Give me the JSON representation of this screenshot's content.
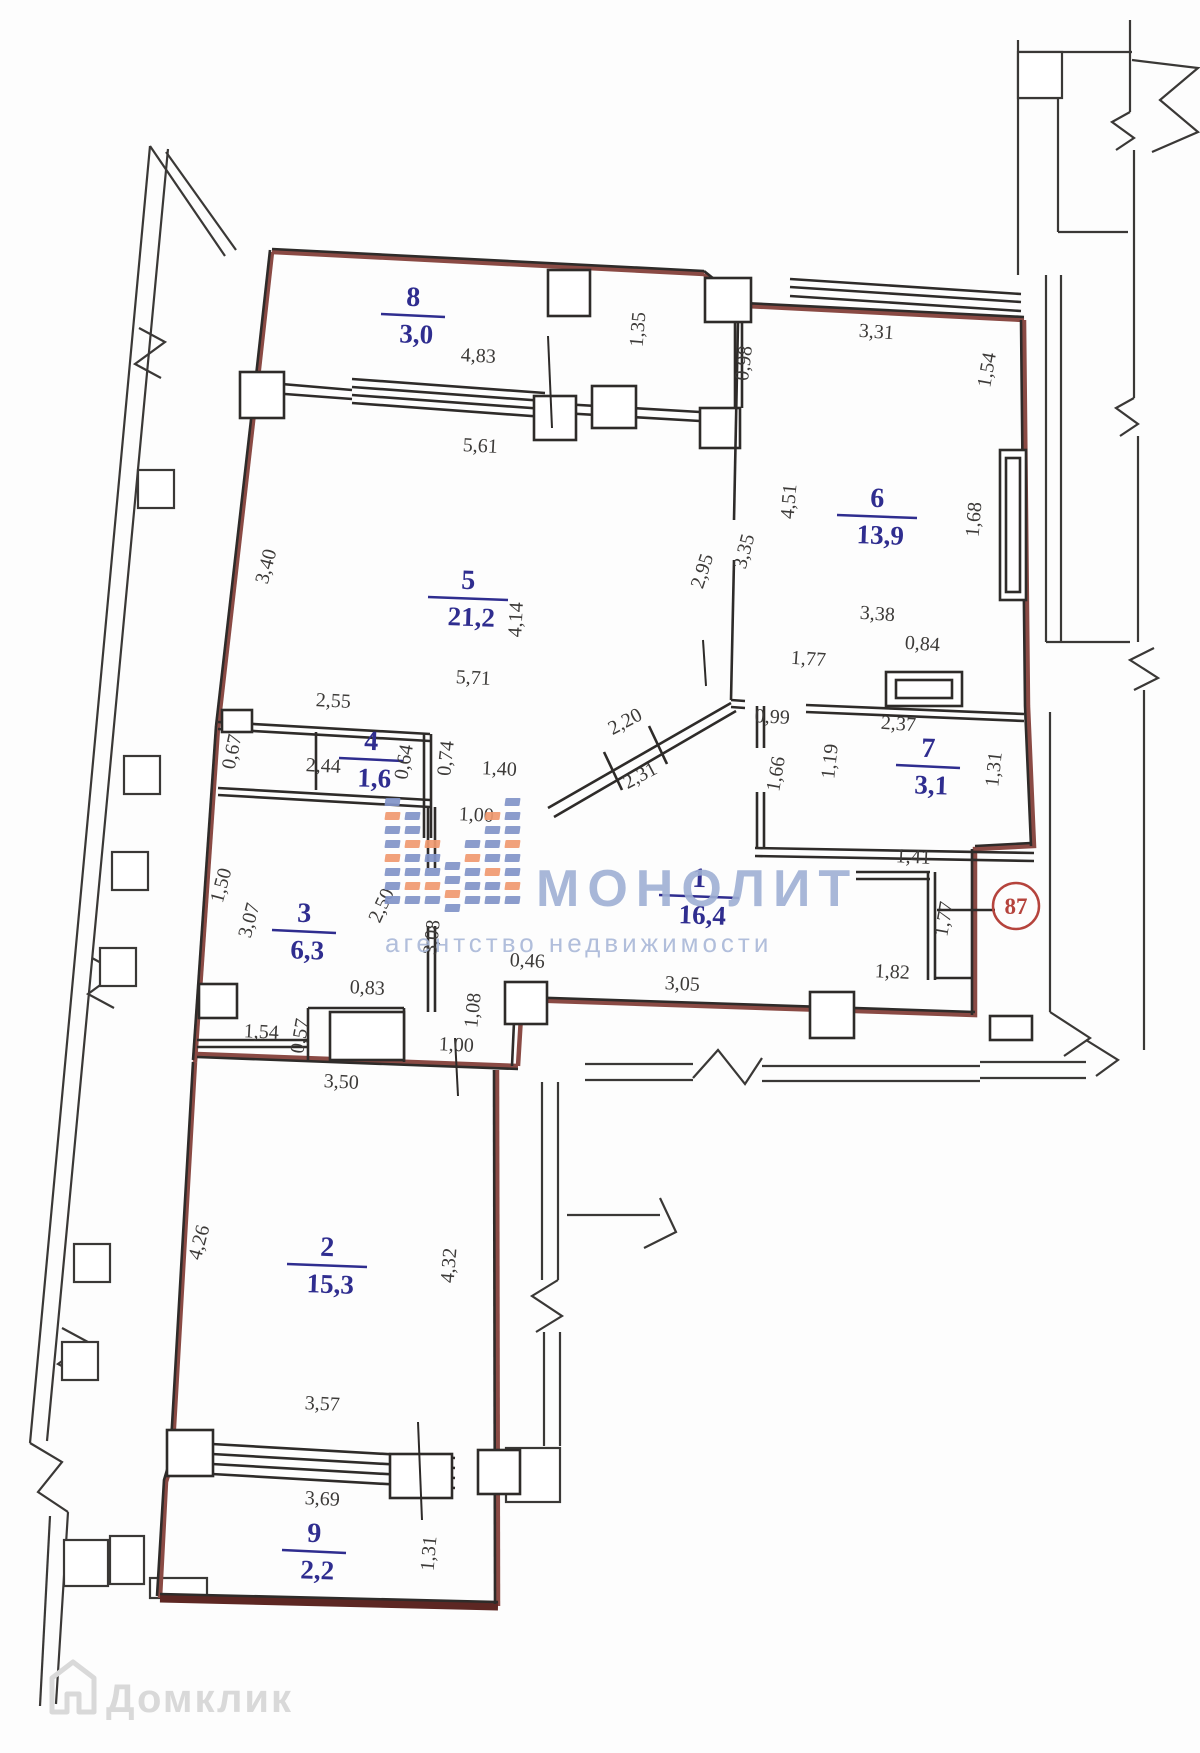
{
  "plan": {
    "description": "Scanned apartment floor plan with room areas and wall dimensions in metres",
    "rooms": [
      {
        "number": "8",
        "area": "3,0",
        "x": 413,
        "y": 297
      },
      {
        "number": "6",
        "area": "13,9",
        "x": 877,
        "y": 498
      },
      {
        "number": "5",
        "area": "21,2",
        "x": 468,
        "y": 580
      },
      {
        "number": "4",
        "area": "1,6",
        "x": 371,
        "y": 741
      },
      {
        "number": "7",
        "area": "3,1",
        "x": 928,
        "y": 748
      },
      {
        "number": "1",
        "area": "16,4",
        "x": 699,
        "y": 878
      },
      {
        "number": "3",
        "area": "6,3",
        "x": 304,
        "y": 913
      },
      {
        "number": "2",
        "area": "15,3",
        "x": 327,
        "y": 1247
      },
      {
        "number": "9",
        "area": "2,2",
        "x": 314,
        "y": 1533
      }
    ],
    "dimensions": [
      {
        "text": "4,83",
        "x": 478,
        "y": 362,
        "rot": 3
      },
      {
        "text": "1,35",
        "x": 644,
        "y": 330,
        "rot": -85
      },
      {
        "text": "5,61",
        "x": 480,
        "y": 452,
        "rot": 3
      },
      {
        "text": "3,31",
        "x": 876,
        "y": 338,
        "rot": 4
      },
      {
        "text": "0,98",
        "x": 750,
        "y": 364,
        "rot": -83
      },
      {
        "text": "1,54",
        "x": 993,
        "y": 371,
        "rot": -80
      },
      {
        "text": "4,51",
        "x": 795,
        "y": 502,
        "rot": -85
      },
      {
        "text": "3,35",
        "x": 750,
        "y": 553,
        "rot": -75
      },
      {
        "text": "2,95",
        "x": 708,
        "y": 573,
        "rot": -72
      },
      {
        "text": "1,68",
        "x": 980,
        "y": 520,
        "rot": -85
      },
      {
        "text": "3,40",
        "x": 272,
        "y": 568,
        "rot": -75
      },
      {
        "text": "4,14",
        "x": 522,
        "y": 620,
        "rot": -87
      },
      {
        "text": "5,71",
        "x": 473,
        "y": 684,
        "rot": 3
      },
      {
        "text": "3,38",
        "x": 877,
        "y": 620,
        "rot": 4
      },
      {
        "text": "0,84",
        "x": 922,
        "y": 650,
        "rot": 4
      },
      {
        "text": "1,77",
        "x": 808,
        "y": 665,
        "rot": 4
      },
      {
        "text": "2,55",
        "x": 333,
        "y": 707,
        "rot": 3
      },
      {
        "text": "2,20",
        "x": 628,
        "y": 727,
        "rot": -28
      },
      {
        "text": "0,99",
        "x": 772,
        "y": 723,
        "rot": 3
      },
      {
        "text": "2,37",
        "x": 898,
        "y": 730,
        "rot": 4
      },
      {
        "text": "0,67",
        "x": 238,
        "y": 753,
        "rot": -78
      },
      {
        "text": "2,44",
        "x": 323,
        "y": 772,
        "rot": 3
      },
      {
        "text": "0,64",
        "x": 410,
        "y": 763,
        "rot": -80
      },
      {
        "text": "0,74",
        "x": 452,
        "y": 759,
        "rot": -84
      },
      {
        "text": "1,40",
        "x": 499,
        "y": 775,
        "rot": 3
      },
      {
        "text": "2,31",
        "x": 643,
        "y": 781,
        "rot": -28
      },
      {
        "text": "1,19",
        "x": 836,
        "y": 762,
        "rot": -84
      },
      {
        "text": "1,66",
        "x": 782,
        "y": 775,
        "rot": -80
      },
      {
        "text": "1,31",
        "x": 1000,
        "y": 770,
        "rot": -84
      },
      {
        "text": "1,00",
        "x": 476,
        "y": 821,
        "rot": 3
      },
      {
        "text": "1,41",
        "x": 913,
        "y": 863,
        "rot": 3
      },
      {
        "text": "1,77",
        "x": 950,
        "y": 920,
        "rot": -80
      },
      {
        "text": "1,50",
        "x": 227,
        "y": 887,
        "rot": -75
      },
      {
        "text": "3,07",
        "x": 255,
        "y": 922,
        "rot": -75
      },
      {
        "text": "2,50",
        "x": 387,
        "y": 908,
        "rot": -65
      },
      {
        "text": "3,08",
        "x": 438,
        "y": 938,
        "rot": -84
      },
      {
        "text": "1,82",
        "x": 892,
        "y": 978,
        "rot": 3
      },
      {
        "text": "3,05",
        "x": 682,
        "y": 990,
        "rot": 3
      },
      {
        "text": "0,46",
        "x": 527,
        "y": 967,
        "rot": 3
      },
      {
        "text": "0,83",
        "x": 367,
        "y": 994,
        "rot": 3
      },
      {
        "text": "1,08",
        "x": 479,
        "y": 1011,
        "rot": -84
      },
      {
        "text": "1,54",
        "x": 261,
        "y": 1038,
        "rot": 3
      },
      {
        "text": "0,57",
        "x": 306,
        "y": 1037,
        "rot": -80
      },
      {
        "text": "1,00",
        "x": 456,
        "y": 1051,
        "rot": 3
      },
      {
        "text": "3,50",
        "x": 341,
        "y": 1088,
        "rot": 3
      },
      {
        "text": "4,26",
        "x": 205,
        "y": 1244,
        "rot": -75
      },
      {
        "text": "4,32",
        "x": 455,
        "y": 1266,
        "rot": -85
      },
      {
        "text": "3,57",
        "x": 322,
        "y": 1410,
        "rot": 3
      },
      {
        "text": "3,69",
        "x": 322,
        "y": 1505,
        "rot": 3
      },
      {
        "text": "1,31",
        "x": 435,
        "y": 1554,
        "rot": -85
      }
    ],
    "unit_badge": {
      "text": "87",
      "x": 1016,
      "y": 906,
      "color": "#b5433c"
    },
    "colors": {
      "wall": "#2e2b29",
      "boundary_red": "#8a4a44",
      "balcony_red": "#63２a26",
      "room_label_blue": "#2f2d8f",
      "dimension_text": "#3c3a38"
    }
  },
  "watermarks": {
    "brand": {
      "text": "МОНОЛИТ",
      "color": "#9fb0d4",
      "x": 536,
      "y": 906,
      "size": 52,
      "spacing": 8
    },
    "brand_sub": {
      "text": "агентство недвижимости",
      "color": "#a9b8d8",
      "x": 385,
      "y": 952,
      "size": 26,
      "spacing": 4
    },
    "footer": {
      "text": "Домклик",
      "color": "#d9d9d9",
      "x": 106,
      "y": 1712,
      "size": 40
    },
    "logo_colors": {
      "blue": "#8294c8",
      "orange": "#f09a70"
    }
  }
}
